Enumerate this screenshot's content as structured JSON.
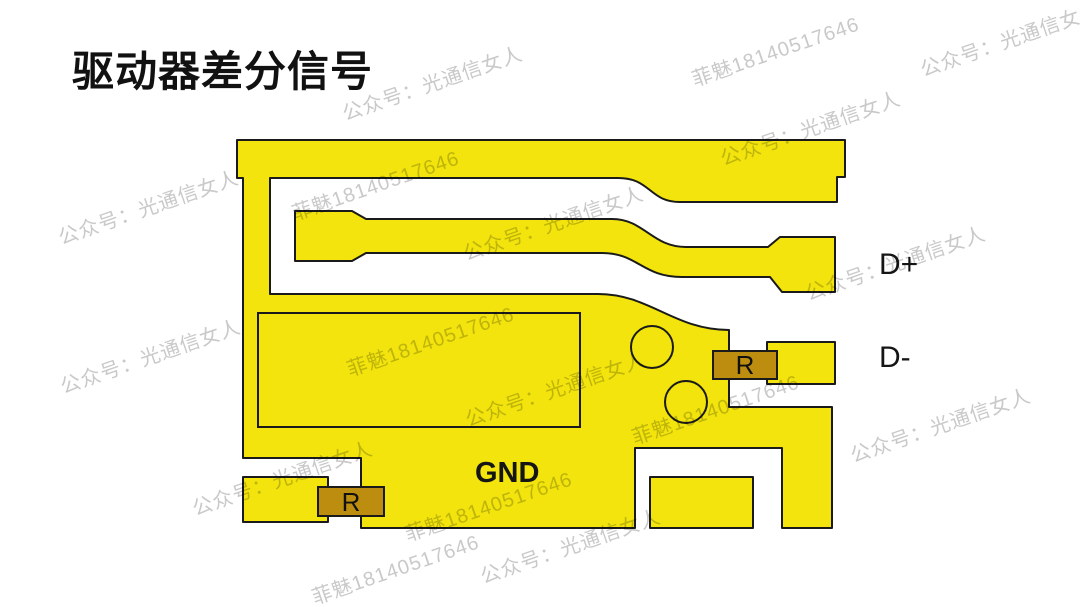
{
  "title": "驱动器差分信号",
  "diagram": {
    "label_d_plus": "D+",
    "label_d_minus": "D-",
    "label_gnd": "GND",
    "resistor_top_label": "R",
    "resistor_bottom_label": "R"
  },
  "colors": {
    "copper": "#F2E40C",
    "resistor": "#BC8D0E",
    "outline": "#1A1A1A",
    "watermark": "#C9C9C9",
    "background": "#FFFFFF",
    "text": "#111111"
  },
  "watermarks": {
    "items": [
      {
        "x": 432,
        "y": 82,
        "text": "公众号：光通信女人"
      },
      {
        "x": 775,
        "y": 50,
        "text": "菲魅18140517646"
      },
      {
        "x": 1010,
        "y": 38,
        "text": "公众号：光通信女人"
      },
      {
        "x": 148,
        "y": 206,
        "text": "公众号：光通信女人"
      },
      {
        "x": 375,
        "y": 184,
        "text": "菲魅18140517646"
      },
      {
        "x": 553,
        "y": 222,
        "text": "公众号：光通信女人"
      },
      {
        "x": 810,
        "y": 127,
        "text": "公众号：光通信女人"
      },
      {
        "x": 895,
        "y": 262,
        "text": "公众号：光通信女人"
      },
      {
        "x": 150,
        "y": 355,
        "text": "公众号：光通信女人"
      },
      {
        "x": 430,
        "y": 340,
        "text": "菲魅18140517646"
      },
      {
        "x": 555,
        "y": 388,
        "text": "公众号：光通信女人"
      },
      {
        "x": 715,
        "y": 408,
        "text": "菲魅18140517646"
      },
      {
        "x": 940,
        "y": 424,
        "text": "公众号：光通信女人"
      },
      {
        "x": 282,
        "y": 477,
        "text": "公众号：光通信女人"
      },
      {
        "x": 488,
        "y": 505,
        "text": "菲魅18140517646"
      },
      {
        "x": 570,
        "y": 545,
        "text": "公众号：光通信女人"
      },
      {
        "x": 395,
        "y": 568,
        "text": "菲魅18140517646"
      }
    ]
  }
}
